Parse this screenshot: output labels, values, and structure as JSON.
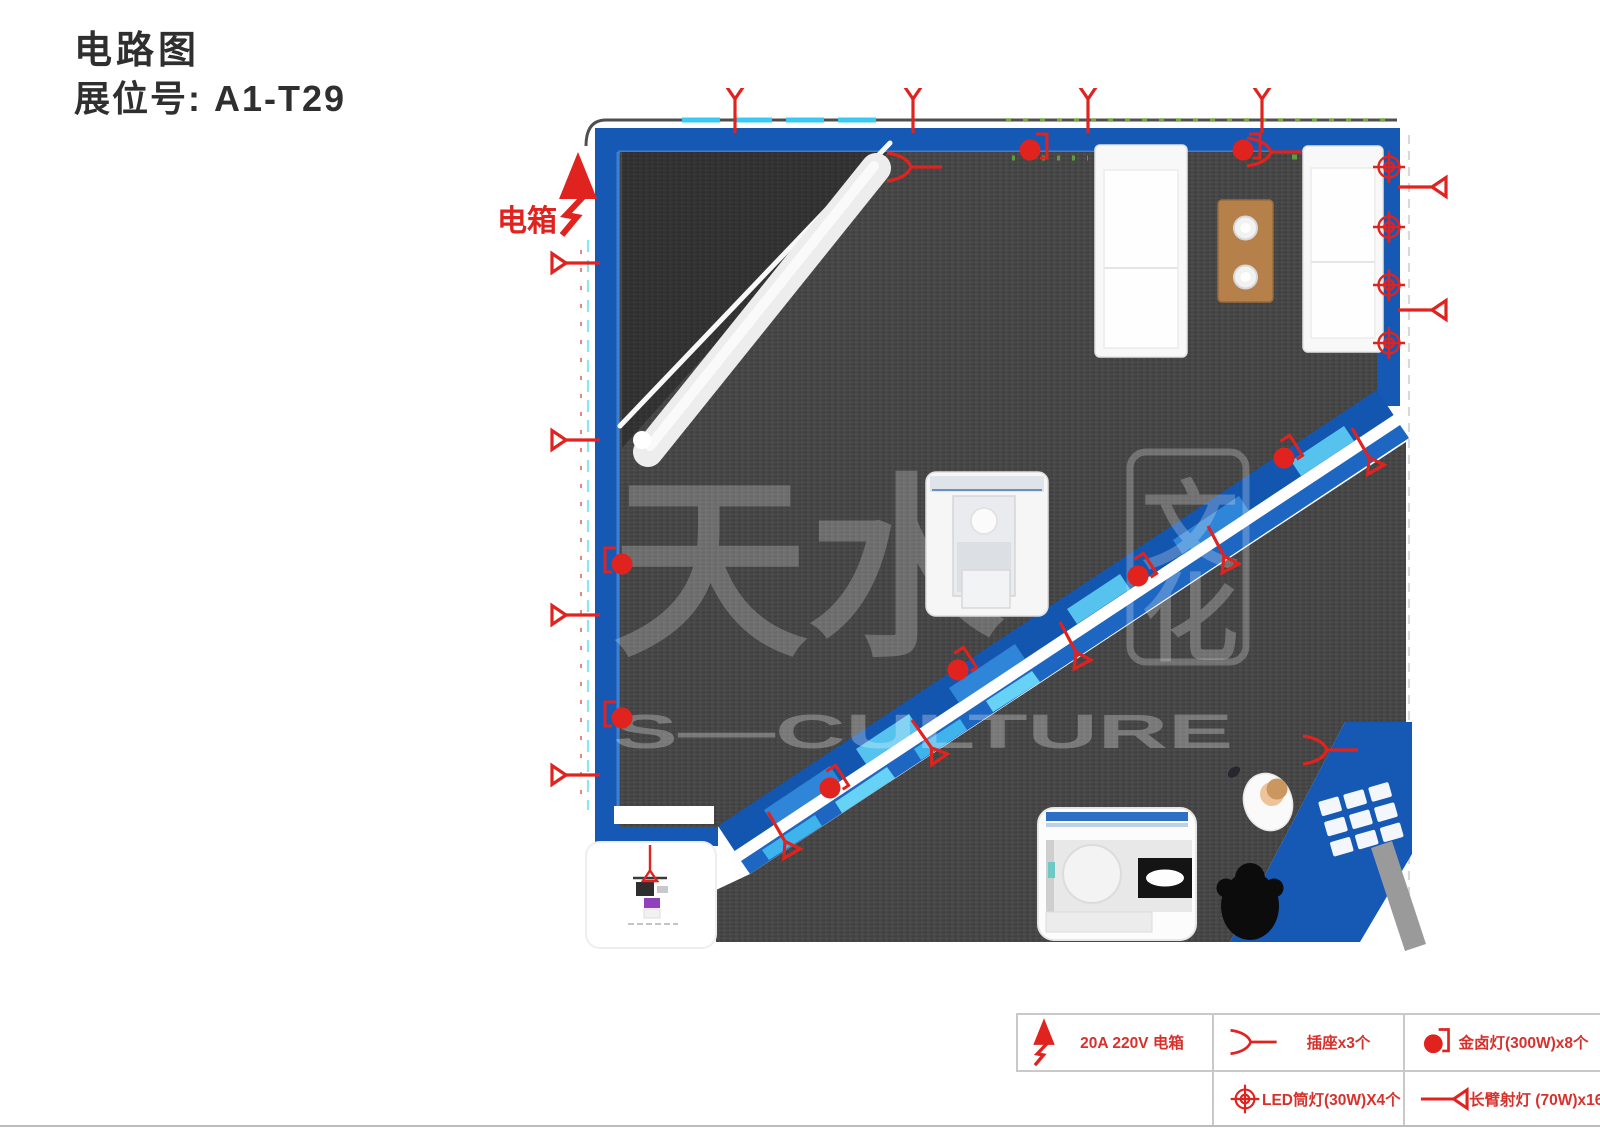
{
  "page": {
    "title_line1": "电路图",
    "title_line2": "展位号: A1-T29",
    "booth_no": "A1-T29"
  },
  "plan": {
    "ebox_label": "电箱",
    "watermark_cjk": "天水",
    "watermark_boxed_top": "文",
    "watermark_boxed_bottom": "化",
    "watermark_latin": "S—CULTURE"
  },
  "legend": {
    "items": [
      {
        "id": "electric-box",
        "label": "20A 220V 电箱"
      },
      {
        "id": "socket",
        "label": "插座x3个"
      },
      {
        "id": "metal-halide-lamp",
        "label": "金卤灯(300W)x8个"
      },
      {
        "id": "led-downlight",
        "label": "LED筒灯(30W)X4个"
      },
      {
        "id": "long-arm-spotlight",
        "label": "长臂射灯 (70W)x16个"
      }
    ]
  },
  "colors": {
    "accent_red": "#e0231f",
    "wall_blue": "#1659b5",
    "walkway_blue": "#1356b0",
    "panel_cyan": "#56c3ef",
    "carpet_gray": "#474747"
  }
}
